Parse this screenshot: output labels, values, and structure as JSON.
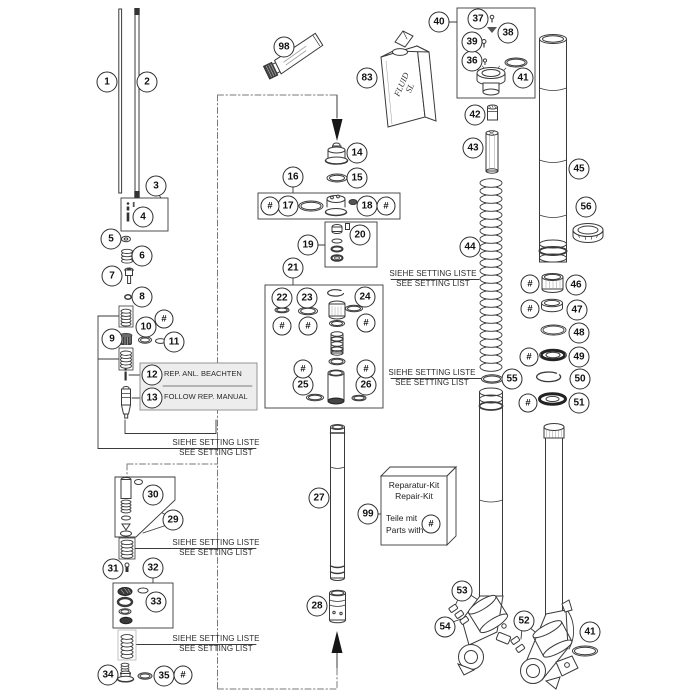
{
  "meta": {
    "type": "exploded-parts-diagram",
    "subject": "front fork"
  },
  "colors": {
    "line": "#3a3a3a",
    "dashed": "#7a7a7a",
    "note_box_bg": "#ededed",
    "dark_part": "#3a3a3a"
  },
  "texts": {
    "rep_note_line1": "REP. ANL. BEACHTEN",
    "rep_note_line2": "FOLLOW REP. MANUAL",
    "kit_line1": "Reparatur-Kit",
    "kit_line2": "Repair-Kit",
    "kit_line3": "Teile mit",
    "kit_line4": "Parts with",
    "bottle_line1": "FLUID",
    "bottle_line2": "SL"
  },
  "setting_note": {
    "line1": "SIEHE SETTING LISTE",
    "line2": "SEE SETTING LIST",
    "positions": [
      {
        "x": 433,
        "y": 269
      },
      {
        "x": 432,
        "y": 368
      },
      {
        "x": 216,
        "y": 438
      },
      {
        "x": 216,
        "y": 538
      },
      {
        "x": 216,
        "y": 634
      }
    ]
  },
  "hash_symbol": "#",
  "hash_positions": [
    {
      "x": 164,
      "y": 319
    },
    {
      "x": 270,
      "y": 206
    },
    {
      "x": 386,
      "y": 206
    },
    {
      "x": 282,
      "y": 326
    },
    {
      "x": 308,
      "y": 326
    },
    {
      "x": 366,
      "y": 323
    },
    {
      "x": 303,
      "y": 369
    },
    {
      "x": 366,
      "y": 369
    },
    {
      "x": 530,
      "y": 284
    },
    {
      "x": 530,
      "y": 309
    },
    {
      "x": 529,
      "y": 357
    },
    {
      "x": 528,
      "y": 403
    },
    {
      "x": 183,
      "y": 675
    },
    {
      "x": 431,
      "y": 524
    }
  ],
  "callouts": [
    {
      "label": "1",
      "x": 107,
      "y": 82
    },
    {
      "label": "2",
      "x": 147,
      "y": 82
    },
    {
      "label": "3",
      "x": 156,
      "y": 186
    },
    {
      "label": "4",
      "x": 143,
      "y": 217
    },
    {
      "label": "5",
      "x": 111,
      "y": 239
    },
    {
      "label": "6",
      "x": 142,
      "y": 256
    },
    {
      "label": "7",
      "x": 112,
      "y": 276
    },
    {
      "label": "8",
      "x": 142,
      "y": 297
    },
    {
      "label": "9",
      "x": 112,
      "y": 339
    },
    {
      "label": "10",
      "x": 146,
      "y": 327
    },
    {
      "label": "11",
      "x": 174,
      "y": 342
    },
    {
      "label": "12",
      "x": 152,
      "y": 375
    },
    {
      "label": "13",
      "x": 152,
      "y": 398
    },
    {
      "label": "14",
      "x": 357,
      "y": 153
    },
    {
      "label": "15",
      "x": 357,
      "y": 178
    },
    {
      "label": "16",
      "x": 293,
      "y": 177
    },
    {
      "label": "17",
      "x": 288,
      "y": 206
    },
    {
      "label": "18",
      "x": 367,
      "y": 206
    },
    {
      "label": "19",
      "x": 308,
      "y": 245
    },
    {
      "label": "20",
      "x": 360,
      "y": 235
    },
    {
      "label": "21",
      "x": 293,
      "y": 268
    },
    {
      "label": "22",
      "x": 282,
      "y": 298
    },
    {
      "label": "23",
      "x": 307,
      "y": 298
    },
    {
      "label": "24",
      "x": 365,
      "y": 297
    },
    {
      "label": "25",
      "x": 303,
      "y": 385
    },
    {
      "label": "26",
      "x": 366,
      "y": 385
    },
    {
      "label": "27",
      "x": 319,
      "y": 498
    },
    {
      "label": "28",
      "x": 317,
      "y": 606
    },
    {
      "label": "29",
      "x": 173,
      "y": 520
    },
    {
      "label": "30",
      "x": 153,
      "y": 495
    },
    {
      "label": "31",
      "x": 113,
      "y": 569
    },
    {
      "label": "32",
      "x": 153,
      "y": 568
    },
    {
      "label": "33",
      "x": 156,
      "y": 602
    },
    {
      "label": "34",
      "x": 108,
      "y": 675
    },
    {
      "label": "35",
      "x": 164,
      "y": 676
    },
    {
      "label": "36",
      "x": 472,
      "y": 61
    },
    {
      "label": "37",
      "x": 478,
      "y": 19
    },
    {
      "label": "38",
      "x": 508,
      "y": 33
    },
    {
      "label": "39",
      "x": 472,
      "y": 42
    },
    {
      "label": "40",
      "x": 439,
      "y": 22
    },
    {
      "label": "41",
      "x": 523,
      "y": 78
    },
    {
      "label": "42",
      "x": 475,
      "y": 115
    },
    {
      "label": "43",
      "x": 473,
      "y": 148
    },
    {
      "label": "44",
      "x": 470,
      "y": 247
    },
    {
      "label": "45",
      "x": 579,
      "y": 169
    },
    {
      "label": "46",
      "x": 576,
      "y": 285
    },
    {
      "label": "47",
      "x": 577,
      "y": 310
    },
    {
      "label": "48",
      "x": 579,
      "y": 333
    },
    {
      "label": "49",
      "x": 579,
      "y": 357
    },
    {
      "label": "50",
      "x": 580,
      "y": 379
    },
    {
      "label": "51",
      "x": 579,
      "y": 403
    },
    {
      "label": "52",
      "x": 524,
      "y": 621
    },
    {
      "label": "53",
      "x": 462,
      "y": 591
    },
    {
      "label": "54",
      "x": 445,
      "y": 627
    },
    {
      "label": "55",
      "x": 512,
      "y": 379
    },
    {
      "label": "56",
      "x": 586,
      "y": 207
    },
    {
      "label": "83",
      "x": 367,
      "y": 78
    },
    {
      "label": "98",
      "x": 284,
      "y": 47
    },
    {
      "label": "99",
      "x": 368,
      "y": 514
    },
    {
      "label": "41",
      "x": 590,
      "y": 632
    }
  ]
}
